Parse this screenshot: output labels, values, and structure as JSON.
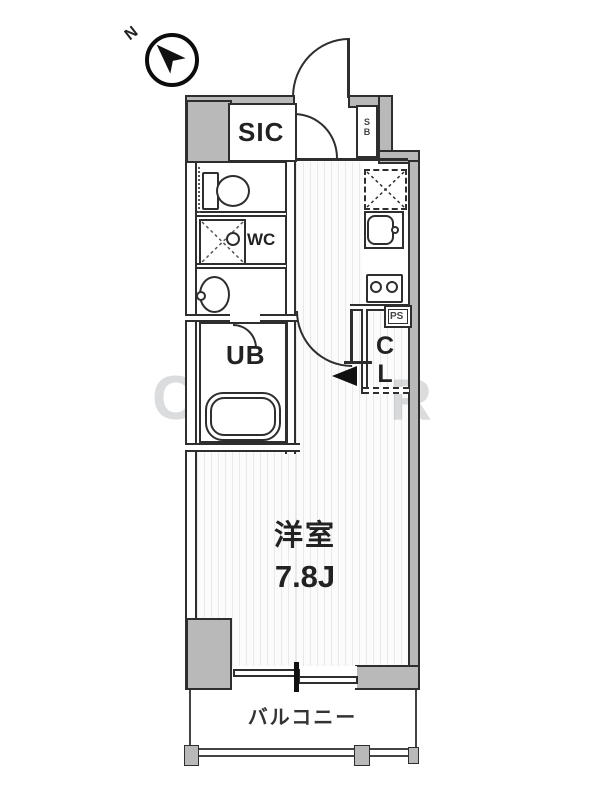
{
  "compass": {
    "north_label": "N"
  },
  "labels": {
    "sic": "SIC",
    "sb": "SB",
    "wc": "WC",
    "ub": "UB",
    "cl": "CL",
    "ps": "PS",
    "room_name": "洋室",
    "room_size": "7.8J",
    "balcony": "バルコニー"
  },
  "watermark": {
    "left_letter": "C",
    "right_letter": "R"
  },
  "colors": {
    "wall_fill": "#b9b9b9",
    "line": "#2e2e2e",
    "floor_stripe": "#e9e9e9",
    "background": "#ffffff"
  }
}
